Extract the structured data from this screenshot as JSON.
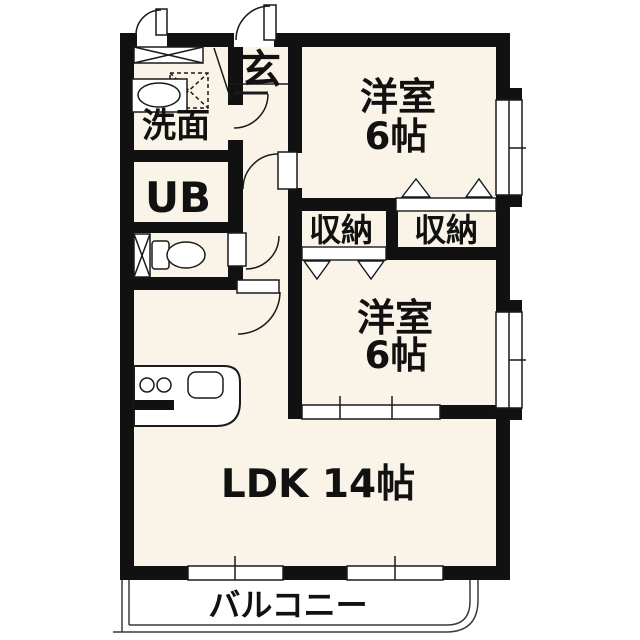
{
  "plan": {
    "colors": {
      "wall": "#111111",
      "floor": "#f9f4e7",
      "line": "#1a1a1a",
      "outside": "#ffffff"
    },
    "labels": {
      "genkan": "玄",
      "washroom": "洗面",
      "unit_bath": "UB",
      "closet_left": "収納",
      "closet_right": "収納",
      "bedroom1_name": "洋室",
      "bedroom1_size": "6帖",
      "bedroom2_name": "洋室",
      "bedroom2_size": "6帖",
      "ldk": "LDK 14帖",
      "balcony": "バルコニー"
    },
    "fixtures": [
      "shoe-cabinet-icon",
      "washing-machine-pan-icon",
      "bathroom-sink-icon",
      "toilet-icon",
      "pipe-space-icon",
      "kitchen-counter",
      "stove-burner-icon",
      "kitchen-sink-icon",
      "closet-folding-door-icon",
      "swing-door-arc-icon",
      "sliding-window-icon",
      "balcony-railing"
    ]
  }
}
